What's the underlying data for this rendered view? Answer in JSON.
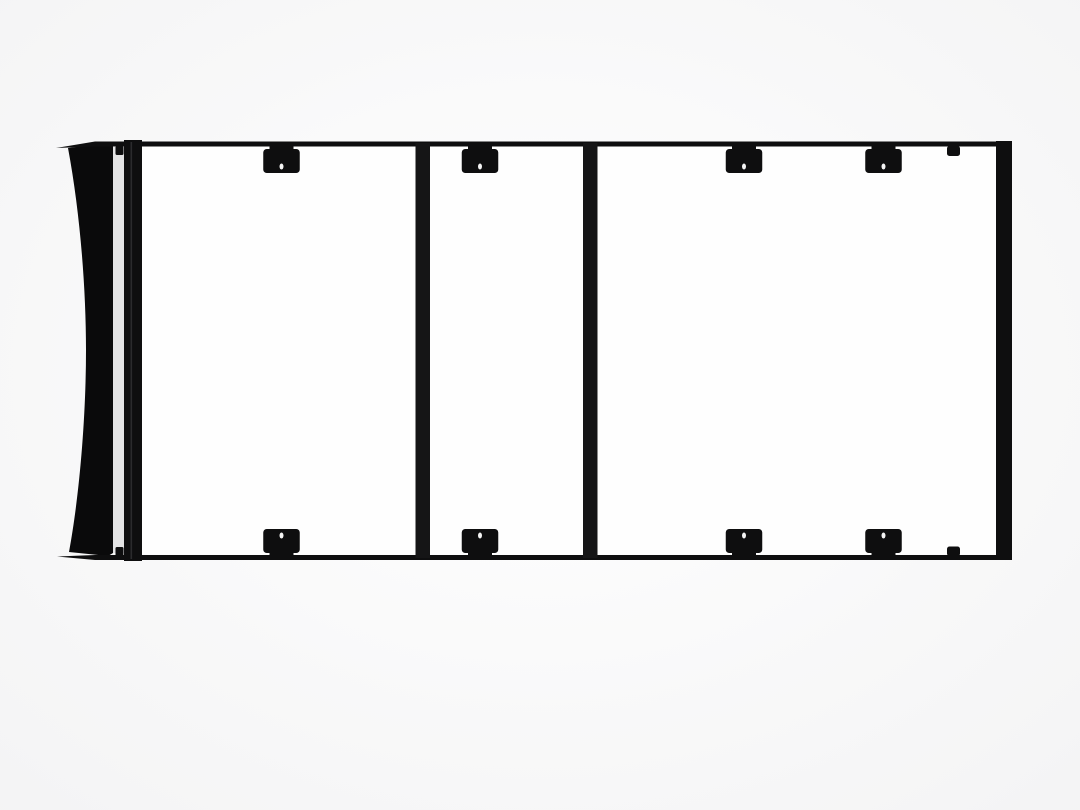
{
  "meta": {
    "alt": "Top view product render of a black flat-platform vehicle roof rack with a wind fairing on the left, front and rear side rails, two cross bars, eight mounting brackets and four small clamp tabs, on a plain white background",
    "subject": "roof-rack-platform-top-view"
  },
  "rack": {
    "canvas": {
      "w": 1080,
      "h": 810
    },
    "colors": {
      "black": "#0e0e0f",
      "black_soft": "#151516",
      "fairing": "#0a0a0b",
      "hole": "#f4f4f4",
      "gap": "#e3e3e4",
      "inner": "#fefefe",
      "bg_center": "#ffffff",
      "bg_edge": "#f3f3f4",
      "seam": "#3c3c3e"
    },
    "frame": {
      "top_rail": {
        "x": 95,
        "y": 141.5,
        "w": 917,
        "h": 5
      },
      "top_tip": {
        "points": "56,148 95,141.5 95,146.5"
      },
      "bottom_rail": {
        "x": 95,
        "y": 555,
        "w": 917,
        "h": 5
      },
      "bottom_tip": {
        "points": "57,556.5 95,555 95,560"
      },
      "left_rail": {
        "x": 124,
        "y": 140,
        "w": 18,
        "h": 421
      },
      "right_rail": {
        "x": 996,
        "y": 141,
        "w": 16,
        "h": 419
      },
      "inner": {
        "x": 132,
        "y": 146.5,
        "w": 872,
        "h": 408
      },
      "seam": {
        "x": 130.5,
        "y": 142,
        "w": 1.6,
        "h": 417,
        "opacity": 0.65
      }
    },
    "fairing": {
      "path": "M 108 143 L 68 148 C 80 212 86 288 86 350 C 86 420 79 498 69 552 L 108 556 L 113 553 L 113 146 Z"
    },
    "gap_shade": {
      "x": 110,
      "y": 147,
      "w": 15,
      "h": 406
    },
    "crossbars": [
      {
        "x": 415.5,
        "y": 143,
        "w": 14.5,
        "h": 415
      },
      {
        "x": 583,
        "y": 143,
        "w": 14.5,
        "h": 415
      }
    ],
    "brackets": {
      "body_w": 36.5,
      "body_h": 24,
      "rx": 3.5,
      "neck_w": 24,
      "neck_h": 4.5,
      "hole_rx": 2,
      "hole_ry": 3,
      "top": {
        "body_y": 149,
        "neck_y": 145.5,
        "hole_cy": 166.5,
        "centers": [
          281.5,
          480,
          744,
          883.5
        ]
      },
      "bottom": {
        "body_y": 529,
        "neck_y": 551.5,
        "hole_cy": 535.5,
        "centers": [
          281.5,
          480,
          744,
          883.5
        ]
      }
    },
    "tabs": [
      {
        "x": 947,
        "y": 146,
        "w": 13,
        "h": 10,
        "rx": 2.5,
        "name": "clamp-tab-top-right"
      },
      {
        "x": 947,
        "y": 546.5,
        "w": 13,
        "h": 9.5,
        "rx": 2.5,
        "name": "clamp-tab-bottom-right"
      },
      {
        "x": 115.5,
        "y": 146,
        "w": 8,
        "h": 9,
        "rx": 1.5,
        "name": "clamp-tab-top-left"
      },
      {
        "x": 115.5,
        "y": 547,
        "w": 8,
        "h": 9,
        "rx": 1.5,
        "name": "clamp-tab-bottom-left"
      }
    ]
  }
}
